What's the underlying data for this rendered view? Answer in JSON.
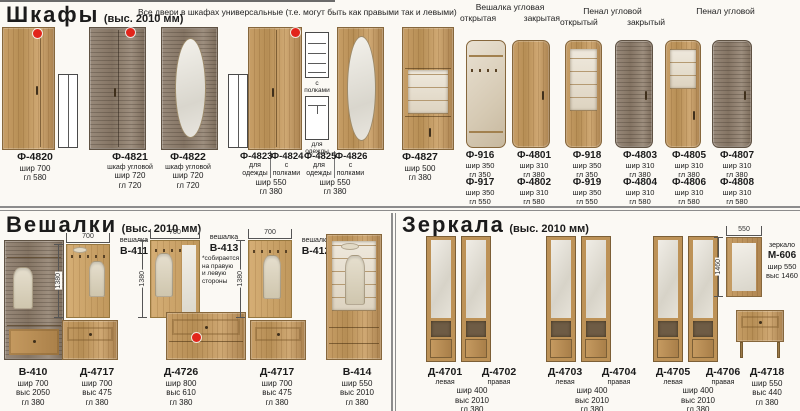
{
  "colors": {
    "accent_red": "#e2251b",
    "wood": "#c39a62",
    "wood_dark": "#8f7f6b",
    "mirror": "#e9e6df"
  },
  "wardrobes": {
    "title": "Шкафы",
    "height_note": "(выс. 2010 мм)",
    "universal_note": "Все двери в шкафах универсальные (т.е. могут быть как правыми так и левыми)",
    "group_headers": [
      {
        "title": "Вешалка угловая",
        "sub_left": "открытая",
        "sub_right": "закрытая"
      },
      {
        "title": "Пенал угловой",
        "sub_left": "открытый",
        "sub_right": "закрытый"
      },
      {
        "title": "Пенал угловой",
        "sub_left": "",
        "sub_right": ""
      }
    ],
    "icon_labels": {
      "shelves": "с\nполками",
      "clothes": "для\nодежды"
    },
    "clothes_note": "для\nодежды",
    "products": [
      {
        "code": "Ф-4820",
        "desc": "",
        "dims": "шир 700\nгл 580"
      },
      {
        "code": "Ф-4821",
        "desc": "шкаф угловой",
        "dims": "шир 720\nгл 720"
      },
      {
        "code": "Ф-4822",
        "desc": "шкаф угловой",
        "dims": "шир 720\nгл 720"
      },
      {
        "code": "Ф-4827",
        "desc": "",
        "dims": "шир 500\nгл 380"
      }
    ],
    "pairs": [
      {
        "left_code": "Ф-4823",
        "left_desc": "для\nодежды",
        "right_code": "Ф-4824",
        "right_desc": "с\nполками",
        "dims": "шир 550\nгл 380"
      },
      {
        "left_code": "Ф-4825",
        "left_desc": "для\nодежды",
        "right_code": "Ф-4826",
        "right_desc": "с\nполками",
        "dims": "шир 550\nгл 380"
      }
    ],
    "grid_row1": [
      {
        "code": "Ф-916",
        "dims": "шир 350\nгл 350"
      },
      {
        "code": "Ф-4801",
        "dims": "шир 310\nгл 380"
      },
      {
        "code": "Ф-918",
        "dims": "шир 350\nгл 350"
      },
      {
        "code": "Ф-4803",
        "dims": "шир 310\nгл 380"
      },
      {
        "code": "Ф-4805",
        "dims": "шир 310\nгл 380"
      },
      {
        "code": "Ф-4807",
        "dims": "шир 310\nгл 380"
      }
    ],
    "grid_row2": [
      {
        "code": "Ф-917",
        "dims": "шир 350\nгл 550"
      },
      {
        "code": "Ф-4802",
        "dims": "шир 310\nгл 580"
      },
      {
        "code": "Ф-919",
        "dims": "шир 350\nгл 550"
      },
      {
        "code": "Ф-4804",
        "dims": "шир 310\nгл 580"
      },
      {
        "code": "Ф-4806",
        "dims": "шир 310\nгл 580"
      },
      {
        "code": "Ф-4808",
        "dims": "шир 310\nгл 580"
      }
    ]
  },
  "hangers": {
    "title": "Вешалки",
    "height_note": "(выс. 2010 мм)",
    "panels": [
      {
        "kind": "вешалка",
        "code": "В-411",
        "note": "",
        "dim_top": "700",
        "dim_side": "1380"
      },
      {
        "kind": "вешалка",
        "code": "В-413",
        "note": "*собирается\nна правую\nи левую\nстороны",
        "dim_top": "700",
        "dim_side": "1380"
      },
      {
        "kind": "вешалка",
        "code": "В-412",
        "note": "",
        "dim_top": "700",
        "dim_side": "1380"
      }
    ],
    "products": [
      {
        "code": "В-410",
        "dims": "шир 700\nвыс 2050\nгл 380"
      },
      {
        "code": "Д-4717",
        "dims": "шир 700\nвыс 475\nгл 380"
      },
      {
        "code": "Д-4726",
        "dims": "шир 800\nвыс 610\nгл 380"
      },
      {
        "code": "Д-4717",
        "dims": "шир 700\nвыс 475\nгл 380"
      },
      {
        "code": "В-414",
        "dims": "шир 550\nвыс 2010\nгл 380"
      }
    ]
  },
  "mirrors": {
    "title": "Зеркала",
    "height_note": "(выс. 2010 мм)",
    "pairs": [
      {
        "left_code": "Д-4701",
        "left_desc": "левая",
        "right_code": "Д-4702",
        "right_desc": "правая",
        "dims": "шир 400\nвыс 2010\nгл 380"
      },
      {
        "left_code": "Д-4703",
        "left_desc": "левая",
        "right_code": "Д-4704",
        "right_desc": "правая",
        "dims": "шир 400\nвыс 2010\nгл 380"
      },
      {
        "left_code": "Д-4705",
        "left_desc": "левая",
        "right_code": "Д-4706",
        "right_desc": "правая",
        "dims": "шир 400\nвыс 2010\nгл 380"
      }
    ],
    "wall_mirror": {
      "kind": "зеркало",
      "code": "М-606",
      "dims": "шир 550\nвыс 1460",
      "dim_top": "550",
      "dim_side": "1460"
    },
    "table": {
      "code": "Д-4718",
      "dims": "шир 550\nвыс 440\nгл 380"
    }
  }
}
